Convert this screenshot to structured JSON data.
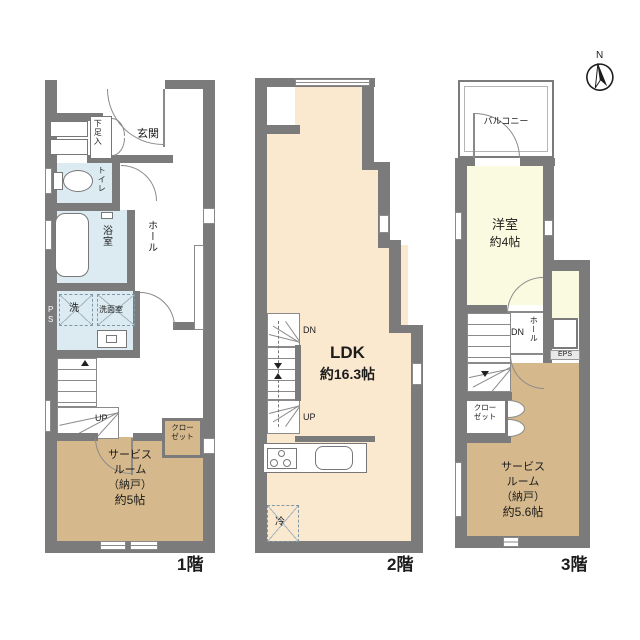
{
  "compass": {
    "north": "N"
  },
  "colors": {
    "wall": "#7b7b7b",
    "ldk_cream": "#fbe9cf",
    "service_tan": "#d5b98c",
    "western_yellow": "#fafae0",
    "wet_area_blue": "#dceaf1",
    "background": "#ffffff"
  },
  "floor1": {
    "floor_label": "1階",
    "shoe": "下足入",
    "genkan": "玄関",
    "toilet": "トイレ",
    "bath": "浴室",
    "hall": "ホール",
    "wash": "洗",
    "washroom": "洗面室",
    "ps": "PS",
    "up": "UP",
    "closet1": "クロー",
    "closet2": "ゼット",
    "sv1": "サービス",
    "sv2": "ルーム",
    "sv3": "（納戸）",
    "sv4": "約5帖"
  },
  "floor2": {
    "floor_label": "2階",
    "ldk1": "LDK",
    "ldk2": "約16.3帖",
    "dn": "DN",
    "up": "UP",
    "fridge": "冷"
  },
  "floor3": {
    "floor_label": "3階",
    "balcony": "バルコニー",
    "room1": "洋室",
    "room2": "約4帖",
    "dn": "DN",
    "hall": "ホール",
    "eps": "EPS",
    "closet1": "クロー",
    "closet2": "ゼット",
    "sv1": "サービス",
    "sv2": "ルーム",
    "sv3": "（納戸）",
    "sv4": "約5.6帖"
  }
}
